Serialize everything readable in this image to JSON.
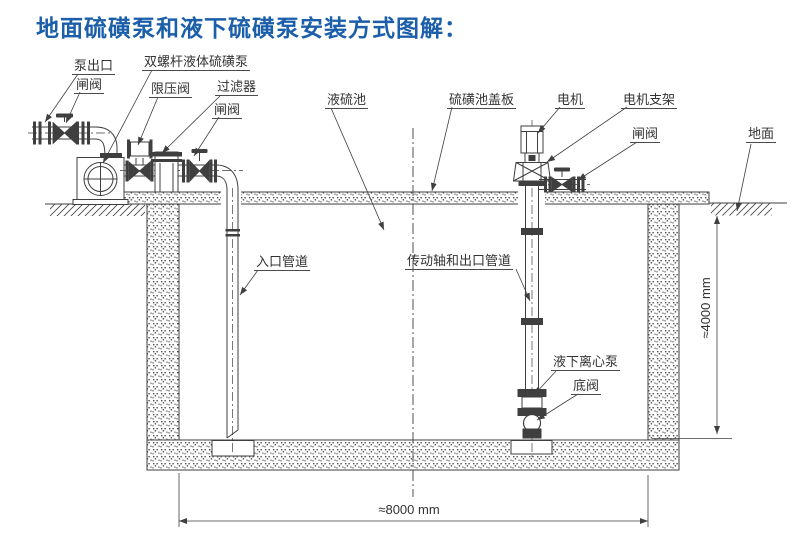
{
  "title": "地面硫磺泵和液下硫磺泵安装方式图解：",
  "colors": {
    "title_blue": "#1b5ea9",
    "line": "#3f3f3f",
    "label_text": "#333333",
    "background": "#ffffff"
  },
  "labels": {
    "pump_outlet": "泵出口",
    "gate_valve_1": "闸阀",
    "twin_screw_pump": "双螺杆液体硫磺泵",
    "pressure_relief_valve": "限压阀",
    "filter": "过滤器",
    "gate_valve_2": "闸阀",
    "liquid_sulfur_pool": "液硫池",
    "pool_cover_plate": "硫磺池盖板",
    "motor": "电机",
    "motor_bracket": "电机支架",
    "gate_valve_3": "闸阀",
    "ground": "地面",
    "inlet_pipe": "入口管道",
    "drive_shaft_and_outlet_pipe": "传动轴和出口管道",
    "submerged_centrifugal_pump": "液下离心泵",
    "foot_valve": "底阀"
  },
  "dimensions": {
    "pit_depth": "≈4000 mm",
    "pit_width": "≈8000 mm"
  }
}
